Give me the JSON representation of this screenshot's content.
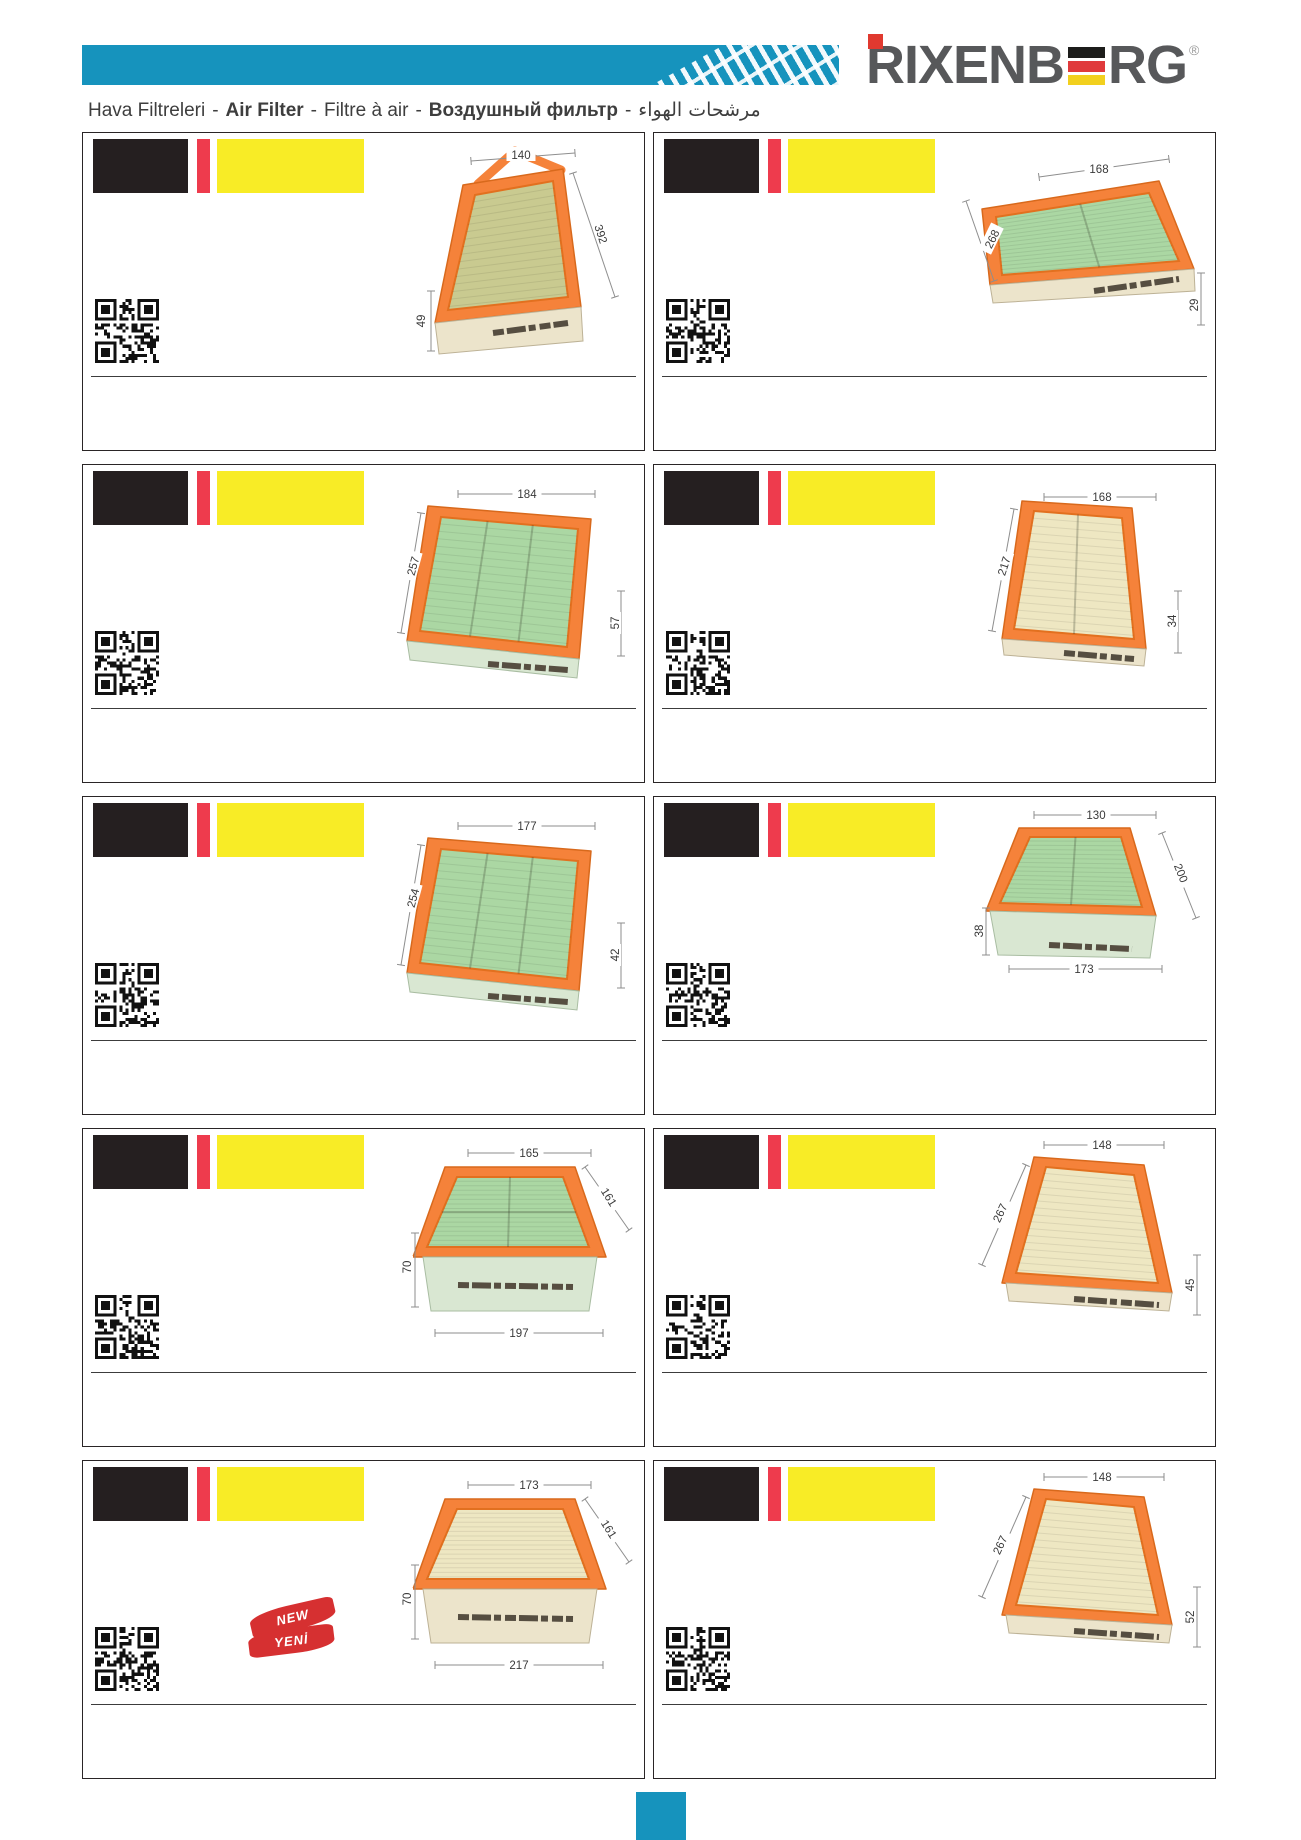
{
  "header": {
    "brand": {
      "left": "RIXENB",
      "right": "RG",
      "registered": "®"
    },
    "sep": "-",
    "title_parts": [
      {
        "text": "Hava Filtreleri",
        "bold": false
      },
      {
        "text": "Air Filter",
        "bold": true
      },
      {
        "text": "Filtre à air",
        "bold": false
      },
      {
        "text": "Воздушный фильтр",
        "bold": true
      },
      {
        "text": "مرشحات الهواء",
        "bold": false
      }
    ]
  },
  "colors": {
    "accent_cyan": "#1693bd",
    "logo_gray": "#57585a",
    "logo_red": "#e0392f",
    "stripe_red": "#ee3b4d",
    "block_black": "#251f20",
    "block_yellow": "#f8ec26",
    "frame_orange": "#f5823a",
    "flag_black": "#1d1d1b",
    "flag_red": "#e03a3c",
    "flag_yellow": "#f2d01e",
    "badge_red": "#d63031"
  },
  "cards": [
    {
      "id": "a1",
      "dims": [
        "140",
        "392",
        "49"
      ]
    },
    {
      "id": "a2",
      "dims": [
        "168",
        "268",
        "29"
      ]
    },
    {
      "id": "a3",
      "dims": [
        "184",
        "257",
        "57"
      ]
    },
    {
      "id": "a4",
      "dims": [
        "168",
        "217",
        "34"
      ]
    },
    {
      "id": "a5",
      "dims": [
        "177",
        "254",
        "42"
      ]
    },
    {
      "id": "a6",
      "dims": [
        "130",
        "200",
        "38",
        "173"
      ]
    },
    {
      "id": "a7",
      "dims": [
        "165",
        "161",
        "70",
        "197"
      ]
    },
    {
      "id": "a8",
      "dims": [
        "148",
        "267",
        "45"
      ]
    },
    {
      "id": "a9",
      "dims": [
        "173",
        "161",
        "70",
        "217"
      ],
      "badge": {
        "line1": "NEW",
        "line2": "YENİ"
      }
    },
    {
      "id": "a10",
      "dims": [
        "148",
        "267",
        "52"
      ]
    }
  ],
  "footer": {
    "marker": "page-marker-square"
  }
}
